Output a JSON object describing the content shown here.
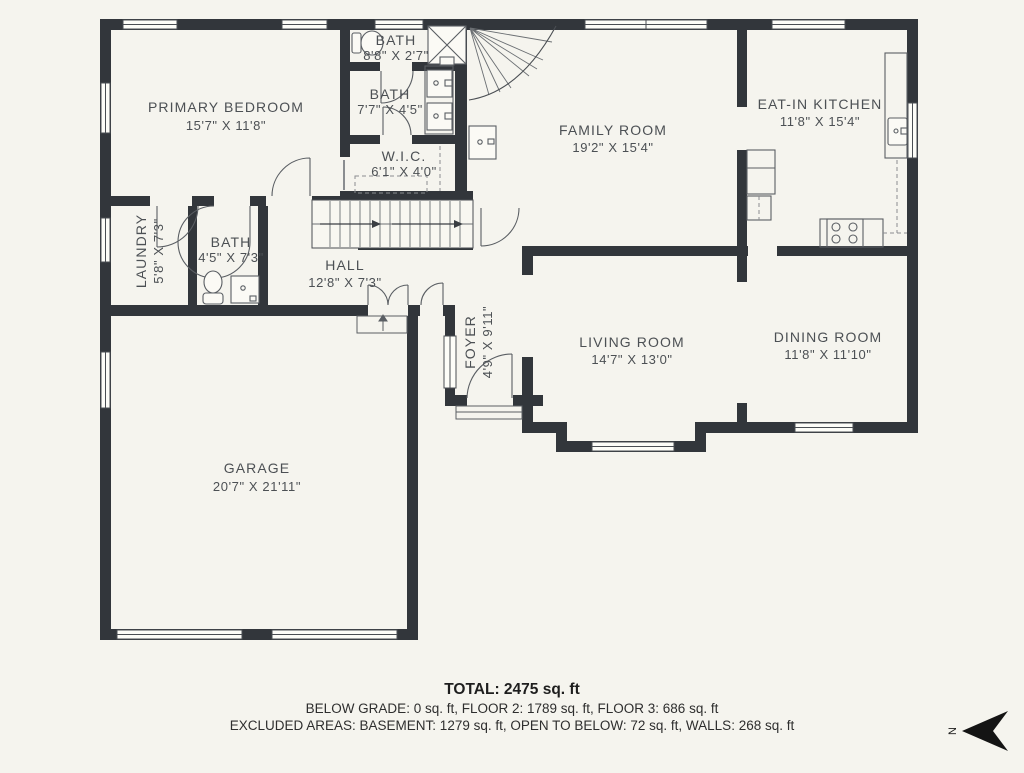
{
  "palette": {
    "background": "#f5f4ee",
    "wall": "#32363b",
    "thin_line": "#4a4e53",
    "label_text": "#4c5054"
  },
  "rooms": [
    {
      "id": "primary-bedroom",
      "name": "PRIMARY BEDROOM",
      "dims": "15'7\" X 11'8\""
    },
    {
      "id": "bath-top",
      "name": "BATH",
      "dims": "8'8\" X 2'7\""
    },
    {
      "id": "bath-primary",
      "name": "BATH",
      "dims": "7'7\" X 4'5\""
    },
    {
      "id": "wic",
      "name": "W.I.C.",
      "dims": "6'1\" X 4'0\""
    },
    {
      "id": "family-room",
      "name": "FAMILY ROOM",
      "dims": "19'2\" X 15'4\""
    },
    {
      "id": "eat-in-kitchen",
      "name": "EAT-IN KITCHEN",
      "dims": "11'8\" X 15'4\""
    },
    {
      "id": "laundry",
      "name": "LAUNDRY",
      "dims": "5'8\" X 7'3\""
    },
    {
      "id": "bath-hall",
      "name": "BATH",
      "dims": "4'5\" X 7'3\""
    },
    {
      "id": "hall",
      "name": "HALL",
      "dims": "12'8\" X 7'3\""
    },
    {
      "id": "foyer",
      "name": "FOYER",
      "dims": "4'9\" X 9'11\""
    },
    {
      "id": "living-room",
      "name": "LIVING ROOM",
      "dims": "14'7\" X 13'0\""
    },
    {
      "id": "dining-room",
      "name": "DINING ROOM",
      "dims": "11'8\" X 11'10\""
    },
    {
      "id": "garage",
      "name": "GARAGE",
      "dims": "20'7\" X 21'11\""
    }
  ],
  "summary": {
    "total": "TOTAL: 2475 sq. ft",
    "floors": "BELOW GRADE: 0 sq. ft, FLOOR 2: 1789 sq. ft, FLOOR 3: 686 sq. ft",
    "excluded": "EXCLUDED AREAS: BASEMENT: 1279 sq. ft, OPEN TO BELOW: 72 sq. ft, WALLS: 268 sq. ft"
  },
  "compass": {
    "label": "N"
  }
}
